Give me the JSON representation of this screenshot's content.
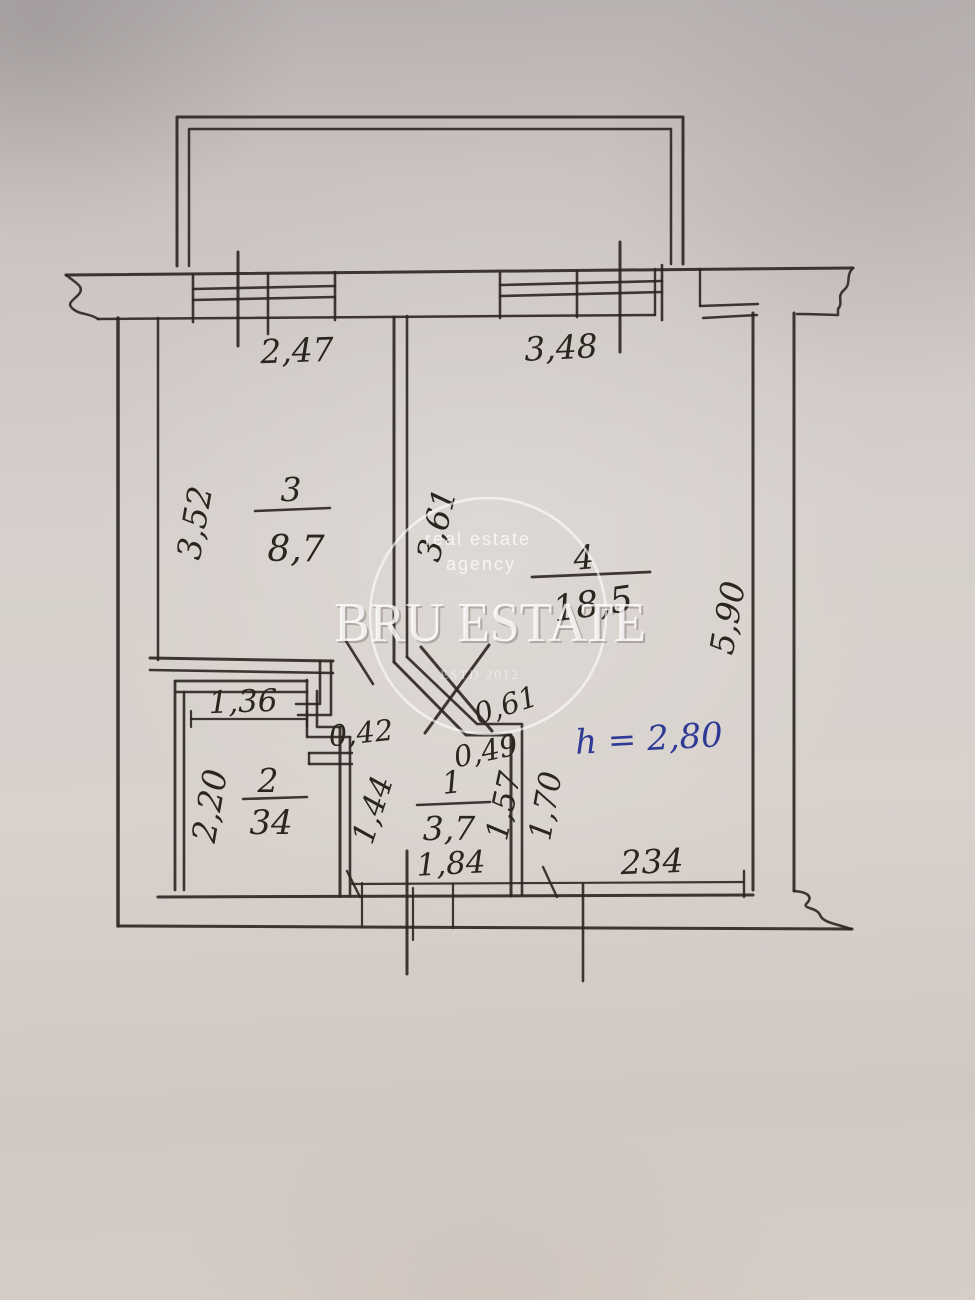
{
  "colors": {
    "ink": "#2b2521",
    "blue_ink": "#2e3a96",
    "paper": "#d3ccc8",
    "watermark": "#ffffff"
  },
  "watermark": {
    "tagline_line1": "real estate",
    "tagline_line2": "agency",
    "brand": "BRU ESTATE",
    "subtext": "ESTD 2012"
  },
  "annotation": {
    "ceiling_height": "h = 2,80"
  },
  "rooms": [
    {
      "id": "room-3",
      "number": "3",
      "area": "8,7"
    },
    {
      "id": "room-4",
      "number": "4",
      "area": "18,5"
    },
    {
      "id": "room-2",
      "number": "2",
      "area": "34"
    },
    {
      "id": "room-1",
      "number": "1",
      "area": "3,7"
    }
  ],
  "dimensions": {
    "window_left": "2,47",
    "window_right": "3,48",
    "room3_depth": "3,52",
    "middle_wall": "3,61",
    "right_side": "5,90",
    "room2_width": "1,36",
    "room2_depth": "2,20",
    "niche": "0,42",
    "diagonal_upper": "0,61",
    "diagonal_lower": "0,49",
    "hall_left": "1,44",
    "hall_right": "1,57",
    "nook_height": "1,70",
    "hall_width": "1,84",
    "bottom_right": "234"
  }
}
